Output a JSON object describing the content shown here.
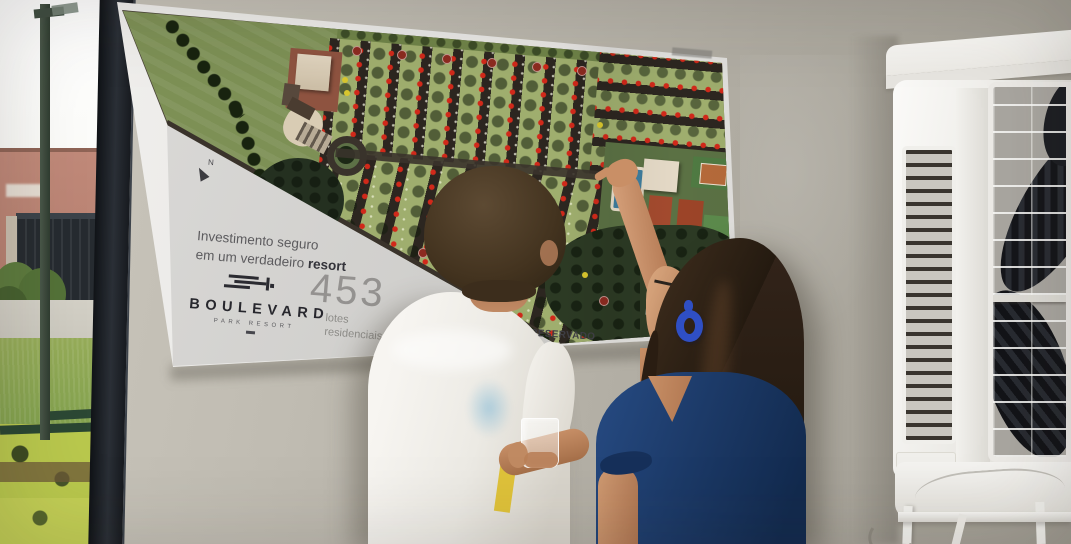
{
  "poster": {
    "tagline_line1": "Investimento seguro",
    "tagline_line2": "em um verdadeiro",
    "tagline_highlight": "resort",
    "brand_name": "BOULEVARD",
    "brand_subtitle": "PARK RESORT",
    "stat_number": "453",
    "stat_label_line1": "lotes",
    "stat_label_line2": "residenciais",
    "reserved_note": "MENTO / RESERVADO",
    "map_labels": {
      "north": "N",
      "forest": "M"
    }
  },
  "colors": {
    "wall": "#b4b0a6",
    "poster_panel": "#d6d5d3",
    "map_field_green": "#7d9055",
    "lot_green": "#9fae6e",
    "street_dark": "#2c2620",
    "forest_green": "#2c3a24",
    "sold_dot_red": "#d1291a",
    "reserved_dot_yellow": "#d8c62e",
    "pool_blue": "#3f7d9d",
    "roof_terracotta": "#a34a2e",
    "shirt_white": "#f2efe9",
    "blouse_navy": "#1c3a68",
    "earring_blue": "#2f4fc4",
    "cooler_white": "#efeeea"
  }
}
